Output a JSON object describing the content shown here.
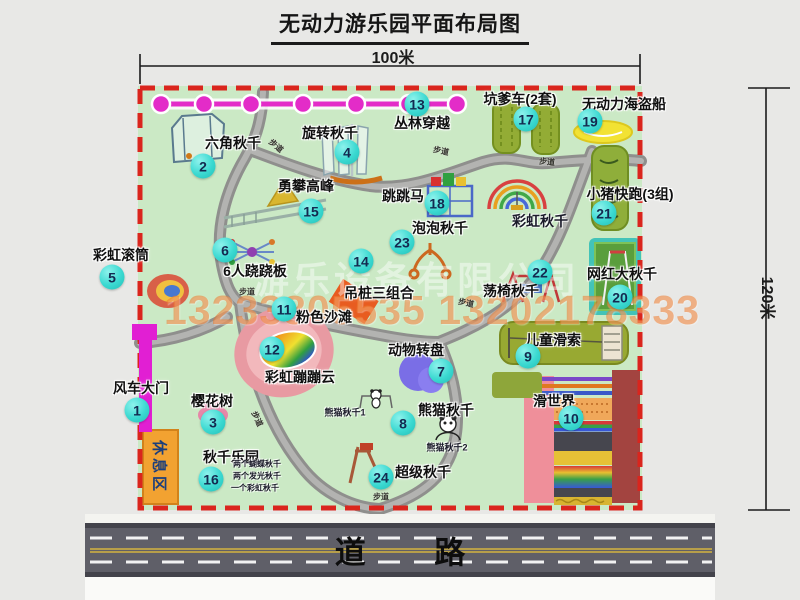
{
  "title": "无动力游乐园平面布局图",
  "dimensions": {
    "top": "100米",
    "right": "120米"
  },
  "road": {
    "label": "道 路"
  },
  "watermark": {
    "company": "游乐设备有限公司",
    "phones": "13233805535 13202178333"
  },
  "rest_area_label": "休息区",
  "walkway_label": "步道",
  "colors": {
    "border": "#da251d",
    "ground": "#cbe9c5",
    "marker": "#3bd9d1",
    "jungle_line": "#e32cc8",
    "gate": "#e11fd3",
    "road": "#5f5f68"
  },
  "walkways": [
    {
      "x": 276,
      "y": 146,
      "rot": 40
    },
    {
      "x": 441,
      "y": 151,
      "rot": 12
    },
    {
      "x": 547,
      "y": 162,
      "rot": 5
    },
    {
      "x": 247,
      "y": 292,
      "rot": 0
    },
    {
      "x": 466,
      "y": 303,
      "rot": 12
    },
    {
      "x": 257,
      "y": 419,
      "rot": 65
    },
    {
      "x": 381,
      "y": 497,
      "rot": 0
    }
  ],
  "attractions": [
    {
      "num": "1",
      "name": "风车大门",
      "lx": 141,
      "ly": 388,
      "mx": 137,
      "my": 410
    },
    {
      "num": "2",
      "name": "六角秋千",
      "lx": 233,
      "ly": 143,
      "mx": 203,
      "my": 166
    },
    {
      "num": "3",
      "name": "樱花树",
      "lx": 212,
      "ly": 401,
      "mx": 213,
      "my": 422
    },
    {
      "num": "4",
      "name": "旋转秋千",
      "lx": 330,
      "ly": 133,
      "mx": 347,
      "my": 152
    },
    {
      "num": "5",
      "name": "彩虹滚筒",
      "lx": 121,
      "ly": 255,
      "mx": 112,
      "my": 277
    },
    {
      "num": "6",
      "name": "6人跷跷板",
      "lx": 255,
      "ly": 271,
      "mx": 225,
      "my": 250
    },
    {
      "num": "7",
      "name": "动物转盘",
      "lx": 416,
      "ly": 350,
      "mx": 441,
      "my": 371
    },
    {
      "num": "8",
      "name": "熊猫秋千",
      "lx": 446,
      "ly": 410,
      "mx": 403,
      "my": 423
    },
    {
      "num": "9",
      "name": "儿童滑索",
      "lx": 553,
      "ly": 340,
      "mx": 528,
      "my": 356
    },
    {
      "num": "10",
      "name": "滑世界",
      "lx": 554,
      "ly": 401,
      "mx": 571,
      "my": 418
    },
    {
      "num": "11",
      "name": "粉色沙滩",
      "lx": 324,
      "ly": 317,
      "mx": 284,
      "my": 309
    },
    {
      "num": "12",
      "name": "彩虹蹦蹦云",
      "lx": 300,
      "ly": 377,
      "mx": 272,
      "my": 349
    },
    {
      "num": "13",
      "name": "丛林穿越",
      "lx": 422,
      "ly": 123,
      "mx": 417,
      "my": 104
    },
    {
      "num": "14",
      "name": "吊桩三组合",
      "lx": 379,
      "ly": 293,
      "mx": 361,
      "my": 261
    },
    {
      "num": "15",
      "name": "勇攀高峰",
      "lx": 306,
      "ly": 186,
      "mx": 311,
      "my": 211
    },
    {
      "num": "16",
      "name": "秋千乐园",
      "lx": 231,
      "ly": 457,
      "mx": 211,
      "my": 479
    },
    {
      "num": "17",
      "name": "坑爹车(2套)",
      "lx": 520,
      "ly": 99,
      "mx": 526,
      "my": 119
    },
    {
      "num": "18",
      "name": "跳跳马",
      "lx": 403,
      "ly": 196,
      "mx": 437,
      "my": 203
    },
    {
      "num": "19",
      "name": "无动力海盗船",
      "lx": 624,
      "ly": 104,
      "mx": 590,
      "my": 121
    },
    {
      "num": "20",
      "name": "网红大秋千",
      "lx": 622,
      "ly": 274,
      "mx": 620,
      "my": 297
    },
    {
      "num": "21",
      "name": "小猪快跑(3组)",
      "lx": 630,
      "ly": 194,
      "mx": 604,
      "my": 213
    },
    {
      "num": "22",
      "name": "荡椅秋千",
      "lx": 511,
      "ly": 291,
      "mx": 540,
      "my": 272
    },
    {
      "num": "23",
      "name": "泡泡秋千",
      "lx": 440,
      "ly": 228,
      "mx": 402,
      "my": 242
    },
    {
      "num": "24",
      "name": "超级秋千",
      "lx": 423,
      "ly": 472,
      "mx": 381,
      "my": 477
    }
  ],
  "sub_labels": [
    {
      "text": "彩虹秋千",
      "x": 540,
      "y": 221,
      "size": 14
    },
    {
      "text": "熊猫秋千1",
      "x": 345,
      "y": 412,
      "size": 9
    },
    {
      "text": "熊猫秋千2",
      "x": 447,
      "y": 447,
      "size": 9
    },
    {
      "text": "两个蝴蝶秋千",
      "x": 257,
      "y": 464,
      "size": 8
    },
    {
      "text": "两个发光秋千",
      "x": 257,
      "y": 476,
      "size": 8
    },
    {
      "text": "一个彩虹秋千",
      "x": 255,
      "y": 488,
      "size": 8
    }
  ]
}
